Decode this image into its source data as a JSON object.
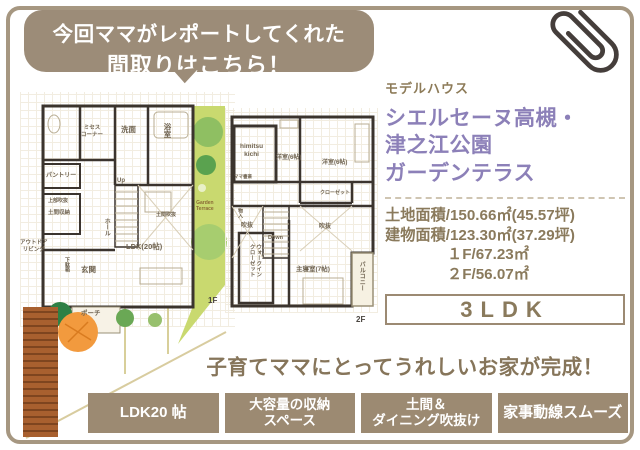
{
  "bubble": {
    "line1": "今回ママがレポートしてくれた",
    "line2": "間取りはこちら！"
  },
  "model_house": {
    "tag": "モデルハウス",
    "name_lines": [
      "シエルセーヌ高槻・",
      "津之江公園",
      "ガーデンテラス"
    ],
    "specs": [
      "土地面積/150.66㎡(45.57坪)",
      "建物面積/123.30㎡(37.29坪)",
      "１F/67.23㎡",
      "２F/56.07㎡"
    ],
    "plan_type": "3LDK"
  },
  "floorplans": {
    "f1": {
      "floor_label": "1F",
      "rooms": [
        {
          "t": "ミセス\nコーナー",
          "x": 61,
          "y": 33,
          "s": 5.5
        },
        {
          "t": "洗面",
          "x": 101,
          "y": 33,
          "s": 7.5
        },
        {
          "t": "浴室",
          "x": 143,
          "y": 31,
          "s": 7.5,
          "v": true
        },
        {
          "t": "パントリー",
          "x": 26,
          "y": 81,
          "s": 6
        },
        {
          "t": "上部吹抜",
          "x": 28,
          "y": 106,
          "s": 5
        },
        {
          "t": "土間収納",
          "x": 28,
          "y": 118,
          "s": 5.5
        },
        {
          "t": "Up",
          "x": 97,
          "y": 86,
          "s": 6
        },
        {
          "t": "ホール",
          "x": 82,
          "y": 126,
          "s": 6,
          "v": true
        },
        {
          "t": "LDK(20帖)",
          "x": 106,
          "y": 150,
          "s": 7.5
        },
        {
          "t": "土間吹抜",
          "x": 136,
          "y": 120,
          "s": 5
        },
        {
          "t": "アウトドア\nリビング",
          "x": 0,
          "y": 148,
          "s": 5.5
        },
        {
          "t": "下駄箱",
          "x": 44,
          "y": 165,
          "s": 5,
          "v": true
        },
        {
          "t": "玄関",
          "x": 61,
          "y": 173,
          "s": 7.5
        },
        {
          "t": "ポーチ",
          "x": 61,
          "y": 218,
          "s": 6.5
        },
        {
          "t": "Garden\nTerrace",
          "x": 176,
          "y": 108,
          "s": 5,
          "c": "#8a6b35"
        },
        {
          "t": "1F",
          "x": 188,
          "y": 204,
          "s": 8,
          "c": "#4a4540"
        }
      ]
    },
    "f2": {
      "floor_label": "2F",
      "rooms": [
        {
          "t": "himitsu\nkichi",
          "x": 15,
          "y": 35,
          "s": 6.5
        },
        {
          "t": "洋室(6帖)",
          "x": 51,
          "y": 47,
          "s": 6
        },
        {
          "t": "洋室(6帖)",
          "x": 97,
          "y": 52,
          "s": 6
        },
        {
          "t": "ママ書斎",
          "x": 9,
          "y": 66,
          "s": 4.5
        },
        {
          "t": "クローゼット",
          "x": 95,
          "y": 82,
          "s": 5
        },
        {
          "t": "吹抜",
          "x": 16,
          "y": 115,
          "s": 6
        },
        {
          "t": "Down",
          "x": 43,
          "y": 127,
          "s": 5.5
        },
        {
          "t": "吹抜",
          "x": 94,
          "y": 116,
          "s": 6
        },
        {
          "t": "物入",
          "x": 12,
          "y": 100,
          "s": 5,
          "v": true
        },
        {
          "t": "ウォークイン\nクローゼット",
          "x": 23,
          "y": 136,
          "s": 5.5,
          "v": true
        },
        {
          "t": "主寝室(7帖)",
          "x": 71,
          "y": 158,
          "s": 6.5
        },
        {
          "t": "バルコニー",
          "x": 132,
          "y": 153,
          "s": 6,
          "v": true
        },
        {
          "t": "2F",
          "x": 131,
          "y": 207,
          "s": 8,
          "c": "#4a4540"
        }
      ]
    }
  },
  "bottom": {
    "catchphrase": "子育てママにとってうれしいお家が完成！",
    "badges": [
      {
        "lines": [
          "LDK20 帖"
        ]
      },
      {
        "lines": [
          "大容量の収納",
          "スペース"
        ]
      },
      {
        "lines": [
          "土間＆",
          "ダイニング吹抜け"
        ]
      },
      {
        "lines": [
          "家事動線スムーズ"
        ]
      }
    ]
  },
  "colors": {
    "frame": "#a69781",
    "bubble": "#9c8c78",
    "badge": "#9c8a72",
    "title_purple": "#8c80b8",
    "text_brown": "#8a7a5c",
    "garden_green": "#c9d96f"
  },
  "icons": {
    "paperclip": "paperclip-icon"
  }
}
